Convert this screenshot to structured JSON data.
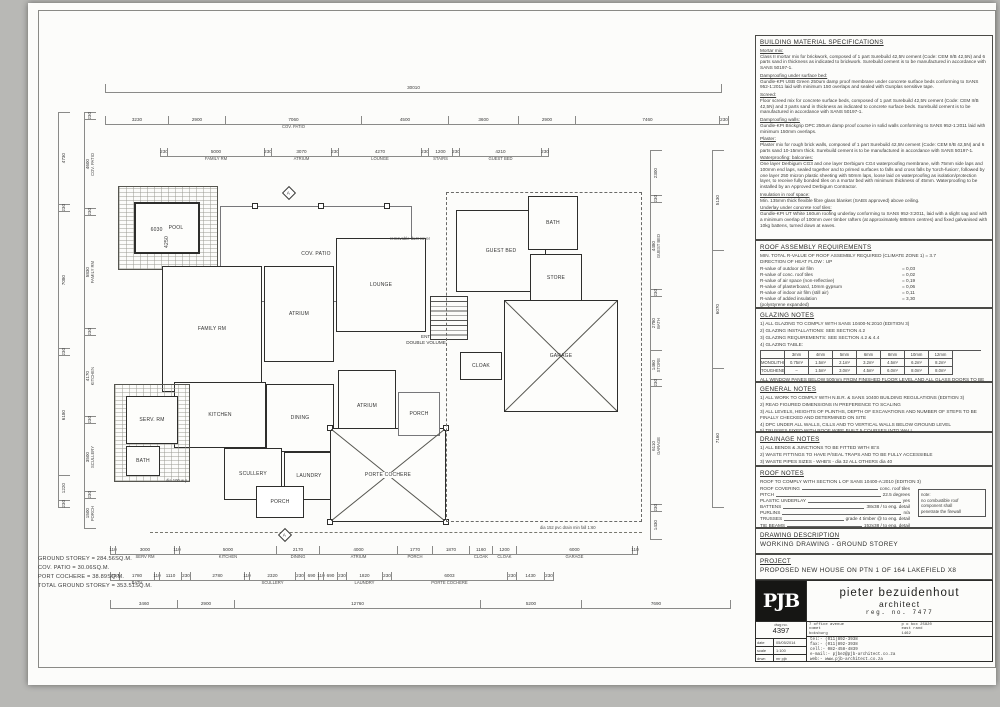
{
  "plan": {
    "rooms": {
      "pool": "POOL",
      "pool_w": "6030",
      "pool_h": "4250",
      "cov_patio": "COV. PATIO",
      "family": "FAMILY RM",
      "atrium1": "ATRIUM",
      "lounge": "LOUNGE",
      "guest": "GUEST BED",
      "bath1": "BATH",
      "store": "STORE",
      "garage": "GARAGE",
      "kitchen": "KITCHEN",
      "dining": "DINING",
      "atrium2": "ATRIUM",
      "serv": "SERV. RM",
      "bath2": "BATH",
      "scullery": "SCULLERY",
      "laundry": "LAUNDRY",
      "porch_b": "PORCH",
      "porte": "PORTE COCHERE",
      "cloak": "CLOAK",
      "porch_r": "PORCH",
      "ent_line1": "ENT.",
      "ent_line2": "DOUBLE VOLUME",
      "section_marker": "A"
    },
    "annotations": {
      "duct": "removable duct cover",
      "drain": "dia 152 pvc drain min fall 1:60",
      "wp": "dia 100 w.p."
    },
    "area_summary": [
      "GROUND STOREY = 284.56SQ.M.",
      "COV. PATIO = 30.06SQ.M.",
      "PORT COCHERE = 38.89SQ.M.",
      "TOTAL GROUND STOREY = 353.51SQ.M."
    ],
    "dims": {
      "t1": [
        {
          "v": "30010",
          "w": 615
        }
      ],
      "t2": [
        {
          "v": "3230",
          "w": 62
        },
        {
          "v": "2900",
          "w": 56
        },
        {
          "v": "7060",
          "s": "COV. PATIO",
          "w": 135
        },
        {
          "v": "4500",
          "w": 86
        },
        {
          "v": "3600",
          "w": 69
        },
        {
          "v": "2900",
          "w": 56
        },
        {
          "v": "7460",
          "w": 143
        },
        {
          "v": "230",
          "w": 8
        }
      ],
      "t3": [
        {
          "v": "230",
          "w": 6
        },
        {
          "v": "5000",
          "s": "FAMILY RM",
          "w": 96
        },
        {
          "v": "230",
          "w": 6
        },
        {
          "v": "3070",
          "s": "ATRIUM",
          "w": 59
        },
        {
          "v": "230",
          "w": 6
        },
        {
          "v": "4270",
          "s": "LOUNGE",
          "w": 82
        },
        {
          "v": "230",
          "w": 6
        },
        {
          "v": "1200",
          "s": "STAIRS",
          "w": 23
        },
        {
          "v": "230",
          "w": 6
        },
        {
          "v": "4210",
          "s": "GUEST BED",
          "w": 81
        },
        {
          "v": "230",
          "w": 6
        }
      ],
      "b1": [
        {
          "v": "110",
          "w": 4
        },
        {
          "v": "3000",
          "s": "SERV RM",
          "w": 58
        },
        {
          "v": "110",
          "w": 4
        },
        {
          "v": "5000",
          "s": "KITCHEN",
          "w": 96
        },
        {
          "v": "2170",
          "s": "DINING",
          "w": 42
        },
        {
          "v": "4000",
          "s": "ATRIUM",
          "w": 77
        },
        {
          "v": "1770",
          "s": "PORCH",
          "w": 34
        },
        {
          "v": "1870",
          "w": 36
        },
        {
          "v": "1160",
          "s": "CLOAK",
          "w": 22
        },
        {
          "v": "1200",
          "s": "CLOAK",
          "w": 23
        },
        {
          "v": "6000",
          "s": "GARAGE",
          "w": 115
        },
        {
          "v": "110",
          "w": 4
        }
      ],
      "b2": [
        {
          "v": "230",
          "w": 8
        },
        {
          "v": "1780",
          "s": "BATH",
          "w": 34
        },
        {
          "v": "110",
          "w": 4
        },
        {
          "v": "1110",
          "w": 21
        },
        {
          "v": "230",
          "w": 8
        },
        {
          "v": "2780",
          "w": 53
        },
        {
          "v": "110",
          "w": 4
        },
        {
          "v": "2320",
          "s": "SCULLERY",
          "w": 45
        },
        {
          "v": "230",
          "w": 8
        },
        {
          "v": "690",
          "w": 13
        },
        {
          "v": "110",
          "w": 4
        },
        {
          "v": "690",
          "w": 13
        },
        {
          "v": "230",
          "w": 8
        },
        {
          "v": "1820",
          "s": "LAUNDRY",
          "w": 35
        },
        {
          "v": "230",
          "w": 8
        },
        {
          "v": "6003",
          "s": "PORTE COCHERE",
          "w": 115
        },
        {
          "v": "230",
          "w": 8
        },
        {
          "v": "1430",
          "w": 27
        },
        {
          "v": "230",
          "w": 8
        }
      ],
      "b3": [
        {
          "v": "3460",
          "w": 66
        },
        {
          "v": "2900",
          "w": 56
        },
        {
          "v": "12760",
          "w": 245
        },
        {
          "v": "5200",
          "w": 100
        },
        {
          "v": "7690",
          "w": 148
        }
      ],
      "lv1": [
        {
          "v": "4730",
          "h": 91
        },
        {
          "v": "230",
          "h": 6
        },
        {
          "v": "7080",
          "h": 136
        },
        {
          "v": "230",
          "h": 6
        },
        {
          "v": "6180",
          "h": 119
        },
        {
          "v": "1220",
          "h": 24
        },
        {
          "v": "230",
          "h": 6
        }
      ],
      "lv2": [
        {
          "v": "230",
          "h": 6
        },
        {
          "v": "4600",
          "s": "COV. PATIO",
          "h": 88
        },
        {
          "v": "230",
          "h": 6
        },
        {
          "v": "5830",
          "s": "FAMILY RM",
          "h": 112
        },
        {
          "v": "230",
          "h": 6
        },
        {
          "v": "4170",
          "s": "KITCHEN",
          "h": 80
        },
        {
          "v": "230",
          "h": 6
        },
        {
          "v": "3500",
          "s": "SCULLERY",
          "h": 67
        },
        {
          "v": "230",
          "h": 6
        },
        {
          "v": "1500",
          "s": "PORCH",
          "h": 29
        }
      ],
      "rv1": [
        {
          "v": "2300",
          "h": 44
        },
        {
          "v": "230",
          "h": 6
        },
        {
          "v": "4480",
          "s": "GUEST BED",
          "h": 86
        },
        {
          "v": "230",
          "h": 6
        },
        {
          "v": "2780",
          "s": "BATH",
          "h": 53
        },
        {
          "v": "1460",
          "s": "STORE",
          "h": 28
        },
        {
          "v": "230",
          "h": 6
        },
        {
          "v": "6110",
          "s": "GARAGE",
          "h": 117
        },
        {
          "v": "230",
          "h": 6
        },
        {
          "v": "1430",
          "h": 27
        }
      ],
      "rv2": [
        {
          "v": "5130",
          "h": 99
        },
        {
          "v": "6070",
          "h": 117
        },
        {
          "v": "7160",
          "h": 138
        }
      ]
    }
  },
  "panel": {
    "specs": {
      "title": "BUILDING MATERIAL SPECIFICATIONS",
      "items": [
        {
          "h": "Mortar mix:",
          "t": "Class II mortar mix for brickwork, composed of 1 part Surebuild 42,5N cement (Code: CEM II/B 42,5N) and 6 parts sand in thickness as indicated to brickwork. Surebuild cement is to be manufactured in accordance with SANS 50197-1."
        },
        {
          "h": "Damproofing under surface bed:",
          "t": "Gundle-KPI USB Green 250um damp proof membrane under concrete surface beds conforming to SANS 952-1:2011 laid with minimum 150 overlaps and sealed with Gunplas sensitive tape."
        },
        {
          "h": "Screed:",
          "t": "Floor screed mix for concrete surface beds, composed of 1 part Surebuild 42,5N cement (Code: CEM II/B 42,5N) and 3 parts sand in thickness as indicated to concrete surface beds. Surebuild cement is to be manufactured in accordance with SANS 50197-1."
        },
        {
          "h": "Damproofing walls:",
          "t": "Gundle-KPI Brickgrip DPC 250um damp proof course in solid walls conforming to SANS 952-1:2011 laid with minimum 150mm overlaps."
        },
        {
          "h": "Plaster:",
          "t": "Plaster mix for rough brick walls, composed of 1 part Surebuild 42,5N cement (Code: CEM II/B 42,5N) and 6 parts sand 10-15mm thick. Surebuild cement is to be manufactured in accordance with SANS 50197-1."
        },
        {
          "h": "Waterproofing: balconies:",
          "t": "One layer Derbigum CG3 and one layer Derbigum CG4 waterproofing membrane, with 75mm side laps and 100mm end laps, sealed together and to primed surfaces to falls and cross falls by 'torch-fusion', followed by one layer 250 micron plastic sheeting with 50mm laps, loose laid on waterproofing as isolation/protection layer, to receive fully bonded tiles on a mortar bed with minimum thickness of 45mm. Waterproofing to be installed by an Approved Derbigum Contractor."
        },
        {
          "h": "Insulation in roof space:",
          "t": "Min. 135mm thick flexible fibre glass blanket (SABS approved) above ceiling."
        },
        {
          "h": "Underlay under concrete roof tiles:",
          "t": "Gundle-KPI UT White 160um roofing underlay conforming to SANS 952-3:2011, laid with a slight sag and with a minimum overlap of 100mm over timber rafters (at approximately 685mm centres) and fixed galvanised with 10kg battens, turned down at eaves."
        }
      ]
    },
    "roof_assembly": {
      "title": "ROOF ASSEMBLY REQUIREMENTS",
      "intro1": "MIN. TOTAL R-VALUE OF ROOF ASSEMBLY REQUIRED (CLIMATE ZONE 1) = 3.7",
      "intro2": "DIRECTION OF HEAT FLOW : UP",
      "rows": [
        {
          "k": "R-value of outdoor air film",
          "v": "= 0,03"
        },
        {
          "k": "R-value of conc. roof tiles",
          "v": "= 0,02"
        },
        {
          "k": "R-value of air space (non-reflective)",
          "v": "= 0,19"
        },
        {
          "k": "R-value of plasterboard, 10mm gypsum",
          "v": "= 0,06"
        },
        {
          "k": "R-value of indoor air film (still air)",
          "v": "= 0,11"
        },
        {
          "k": "R-value of added insulation",
          "v": "= 3,30"
        },
        {
          "k": "(polystyrene expanded)",
          "v": ""
        }
      ],
      "total_k": "TOTAL R-VALUES",
      "total_v": "= 3,70 = REQUIREMENTS"
    },
    "glazing": {
      "title": "GLAZING NOTES",
      "notes": [
        "1) ALL GLAZING TO COMPLY WITH SANS 10400-N:2010 (EDITION 3)",
        "2) GLAZING INSTALLATIONS: SEE SECTION 4.2",
        "3) GLAZING REQUIREMENTS: SEE SECTION 4.2 & 4.4",
        "4) GLAZING TABLE:"
      ],
      "table": {
        "h": [
          "",
          "3mm",
          "4mm",
          "5mm",
          "6mm",
          "8mm",
          "10mm",
          "12mm"
        ],
        "r1": [
          "MONOLITHIC ANNEALED GLASS",
          "0.75m²",
          "1.5m²",
          "2.1m²",
          "3.2m²",
          "4.5m²",
          "6.2m²",
          "8.2m²"
        ],
        "r2": [
          "TOUGHENED SAFETY GLASS",
          "–",
          "1.5m²",
          "3.0m²",
          "4.5m²",
          "6.0m²",
          "8.0m²",
          "8.0m²"
        ]
      },
      "footnote": "ALL WINDOW PANES BELOW 500mm FROM FINISHED FLOOR LEVEL AND ALL GLASS DOORS TO BE GLAZED WITH TOUGHENED SAFETY GLASS TO SABS 0137"
    },
    "general": {
      "title": "GENERAL NOTES",
      "notes": [
        "1) ALL WORK TO COMPLY WITH N.B.R. & SANS 10400 BUILDING REGULATIONS (EDITION 3)",
        "2) READ FIGURED DIMENSIONS IN PREFERENCE TO SCALING",
        "3) ALL LEVELS, HEIGHTS OF PLINTHS, DEPTH OF EXCAVATIONS AND NUMBER OF STEPS TO BE FINALLY CHECKED AND DETERMINED ON SITE",
        "4) DPC UNDER ALL WALLS, CILLS AND TO VERTICAL WALLS BELOW GROUND LEVEL",
        "5) TRUSSES FIXED WITH ROOF WIRE BUILT 5 COURSES INTO WALL"
      ]
    },
    "drainage": {
      "title": "DRAINAGE NOTES",
      "notes": [
        "1) ALL BENDS & JUNCTIONS TO BE FITTED WITH IE'S",
        "2) WASTE FITTINGS TO HAVE P/SEAL TRAPS AND TO BE FULLY ACCESSIBLE",
        "3) WASTE PIPES SIZES - WHB'S - dia 32 ALL OTHERS dia 40",
        "4) ALL DRAINS UNDER BUILDING TO BE ENCASED IN 100mm CONCRETE"
      ]
    },
    "roof_notes": {
      "title": "ROOF NOTES",
      "intro": "ROOF TO COMPLY WITH SECTION L OF SANS 10400-A:2010 (EDITION 3)",
      "rows": [
        {
          "k": "ROOF COVERING",
          "v": "conc. roof tiles"
        },
        {
          "k": "PITCH",
          "v": "22.5 degrees"
        },
        {
          "k": "PLASTIC UNDERLAY",
          "v": "yes"
        },
        {
          "k": "BATTENS",
          "v": "38x38 / to eng. detail"
        },
        {
          "k": "PURLINS",
          "v": "n/a"
        },
        {
          "k": "TRUSSES",
          "v": "grade 4 timber @ to eng. detail"
        },
        {
          "k": "TIE BEAMS",
          "v": "152x38 / to eng. detail"
        }
      ],
      "note": [
        "note:",
        "no combustible roof",
        "component shall",
        "penetrate the firewall"
      ]
    },
    "drawing_description": {
      "title": "DRAWING DESCRIPTION",
      "value": "WORKING DRAWING  -  GROUND STOREY"
    },
    "project": {
      "title": "PROJECT",
      "value": "PROPOSED NEW HOUSE ON PTN 1 OF 164 LAKEFIELD X8"
    },
    "titleblock": {
      "logo": "PJB",
      "name": "pieter bezuidenhout",
      "profession": "architect",
      "reg": "reg. no. 7477",
      "dwg_label": "dwg no.",
      "dwg_no": "4397",
      "address": [
        "7 office avenue",
        "comet",
        "boksburg"
      ],
      "pobox": [
        "p o box 25820",
        "east rand",
        "1462"
      ],
      "meta": [
        {
          "k": "date",
          "v": "05/05/2014"
        },
        {
          "k": "scale",
          "v": "1:100"
        },
        {
          "k": "drwn",
          "v": "mr pjb"
        }
      ],
      "contact": [
        "tel:-  (011)892-3938",
        "fax:-  (011)892-3938",
        "cell:- 082-458-4839",
        "e-mail:- pjbez@pjb-architect.co.za",
        "web:-  www.pjb-architect.co.za"
      ]
    }
  }
}
